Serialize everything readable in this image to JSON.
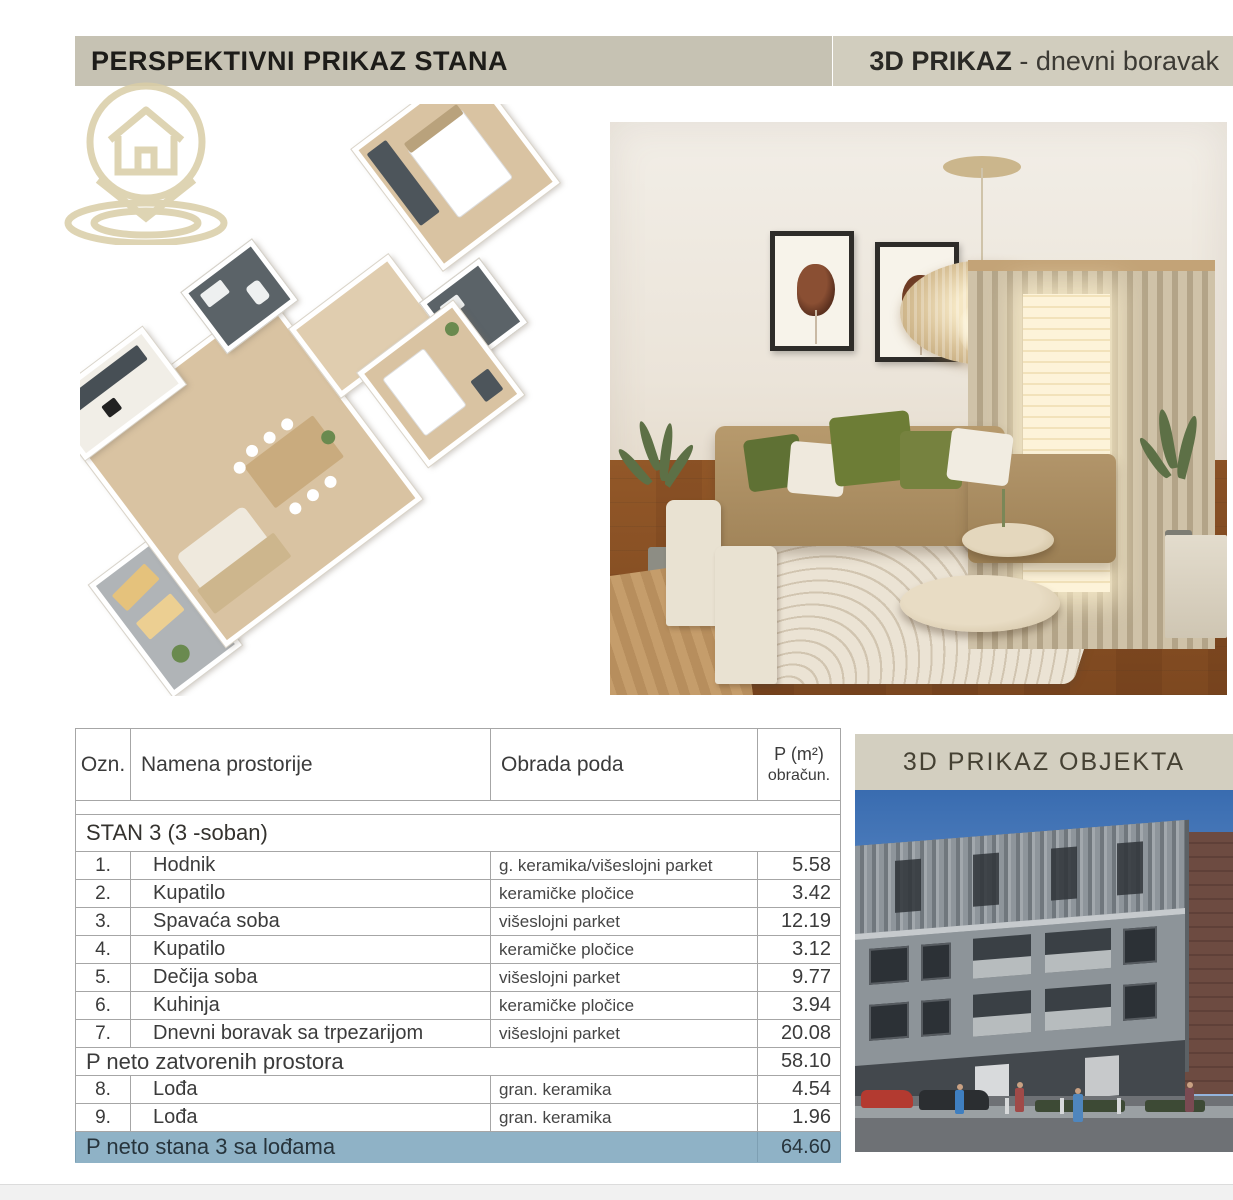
{
  "header": {
    "left_title": "PERSPEKTIVNI PRIKAZ STANA",
    "right_title_bold": "3D PRIKAZ",
    "right_title_rest": " - dnevni boravak"
  },
  "table": {
    "columns": {
      "ozn": "Ozn.",
      "name": "Namena prostorije",
      "floor": "Obrada poda",
      "area_line1": "P (m²)",
      "area_line2": "obračun."
    },
    "section_label": "STAN 3  (3 -soban)",
    "rows": [
      {
        "num": "1.",
        "name": "Hodnik",
        "floor": "g. keramika/višeslojni parket",
        "area": "5.58"
      },
      {
        "num": "2.",
        "name": "Kupatilo",
        "floor": "keramičke pločice",
        "area": "3.42"
      },
      {
        "num": "3.",
        "name": "Spavaća soba",
        "floor": "višeslojni parket",
        "area": "12.19"
      },
      {
        "num": "4.",
        "name": "Kupatilo",
        "floor": "keramičke pločice",
        "area": "3.12"
      },
      {
        "num": "5.",
        "name": "Dečija soba",
        "floor": "višeslojni parket",
        "area": "9.77"
      },
      {
        "num": "6.",
        "name": "Kuhinja",
        "floor": "keramičke pločice",
        "area": "3.94"
      },
      {
        "num": "7.",
        "name": "Dnevni boravak sa trpezarijom",
        "floor": "višeslojni parket",
        "area": "20.08"
      },
      {
        "num": "8.",
        "name": "Lođa",
        "floor": "gran. keramika",
        "area": "4.54"
      },
      {
        "num": "9.",
        "name": "Lođa",
        "floor": "gran. keramika",
        "area": "1.96"
      }
    ],
    "subtotal": {
      "label": "P neto zatvorenih prostora",
      "area": "58.10"
    },
    "total": {
      "label": "P neto stana 3 sa lođama",
      "area": "64.60"
    }
  },
  "objekta": {
    "title": "3D PRIKAZ OBJEKTA"
  },
  "colors": {
    "header_bar": "#c6c2b3",
    "header_bar_right": "#d1cdbe",
    "objekta_bar": "#d3cfc0",
    "total_row": "#8fb2c6",
    "logo_tan": "#d9cda6",
    "table_border": "#a6a6a6"
  }
}
